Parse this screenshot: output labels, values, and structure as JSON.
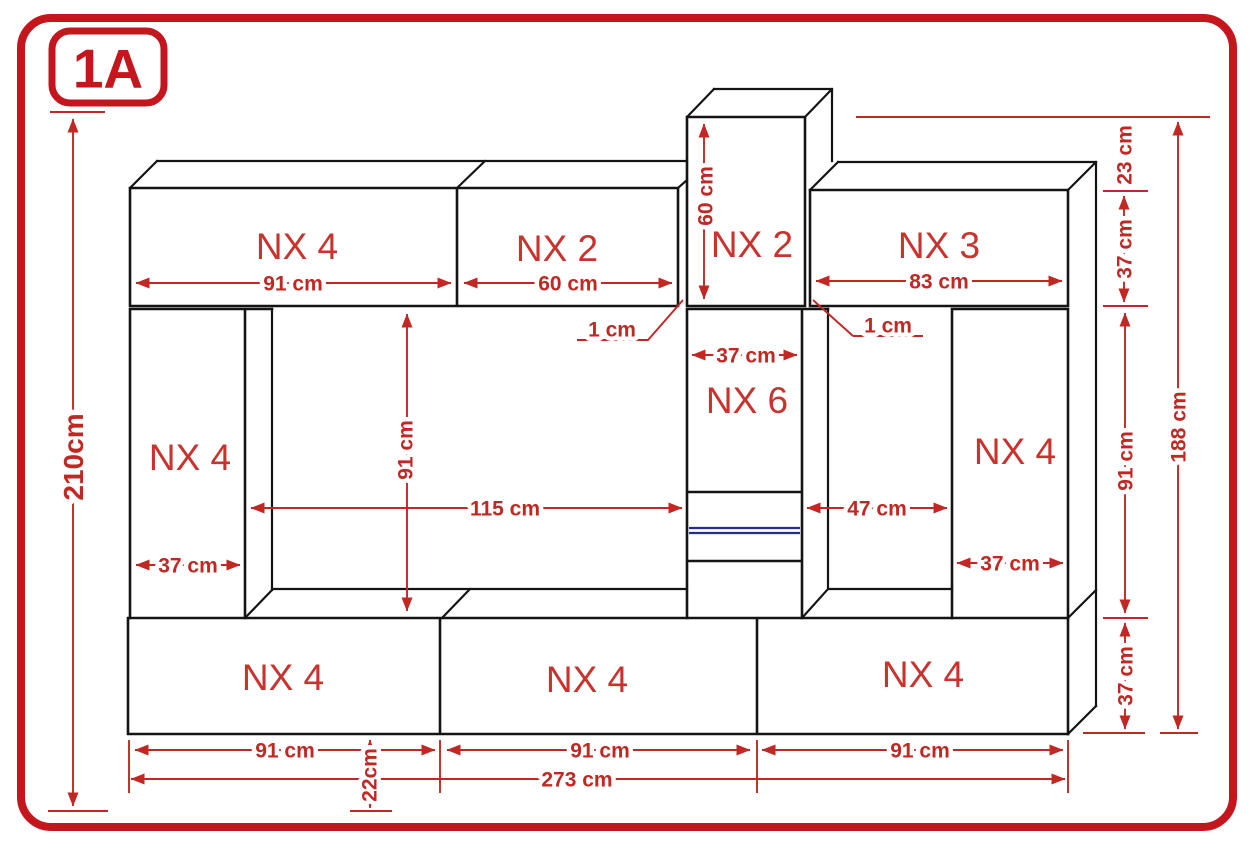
{
  "page": {
    "badge": "1A",
    "type": "furniture-wall-unit-dimension-diagram"
  },
  "cabinet_labels": {
    "top_left": "NX 4",
    "top_middle": "NX 2",
    "tower": "NX 2",
    "top_right": "NX 3",
    "left_column": "NX 4",
    "middle_column": "NX 6",
    "right_column": "NX 4",
    "bottom_left": "NX 4",
    "bottom_middle": "NX 4",
    "bottom_right": "NX 4"
  },
  "dimensions": {
    "total_height": "210cm",
    "total_width": "273 cm",
    "wall_height": "188 cm",
    "top_left_width": "91 cm",
    "top_middle_width": "60 cm",
    "top_right_width": "83 cm",
    "tower_height": "60 cm",
    "tower_above_offset": "23 cm",
    "gap_left": "1 cm",
    "gap_right": "1 cm",
    "middle_column_width": "37 cm",
    "top_row_height": "37 cm",
    "inner_height": "91 cm",
    "inner_left_width": "115 cm",
    "inner_right_width": "47 cm",
    "left_column_width": "37 cm",
    "right_column_width": "37 cm",
    "right_inner_height": "91 cm",
    "bottom_row_height": "37 cm",
    "bottom_left_width": "91 cm",
    "bottom_middle_width": "91 cm",
    "bottom_right_width": "91 cm",
    "plinth_height": "22cm"
  },
  "colors": {
    "accent_red": "#c4161c",
    "dimension_red": "#c22823",
    "outline_black": "#141414",
    "shelf_navy": "#272d8f",
    "background": "#ffffff"
  }
}
